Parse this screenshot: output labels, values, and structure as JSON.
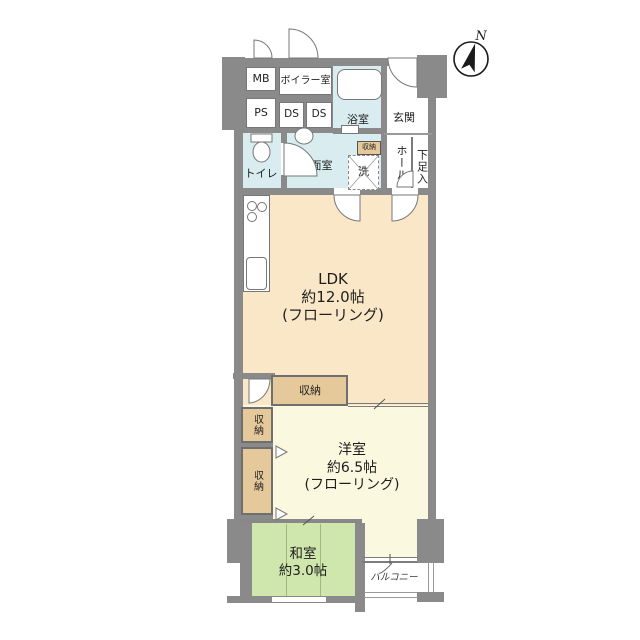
{
  "compass": {
    "north_label": "N"
  },
  "utility": {
    "mb": "MB",
    "boiler_room": "ボイラー室",
    "ps": "PS",
    "ds_left": "DS",
    "ds_right": "DS"
  },
  "wet_area": {
    "bath": "浴室",
    "toilet": "トイレ",
    "washroom": "洗面室",
    "washer": "洗",
    "storage_badge": "収納"
  },
  "entry": {
    "genkan": "玄関",
    "hall": "ホール",
    "shoe_closet": "下足入"
  },
  "ldk": {
    "name": "LDK",
    "size": "約12.0帖",
    "flooring": "(フローリング)"
  },
  "western_room": {
    "name": "洋室",
    "size": "約6.5帖",
    "flooring": "(フローリング)"
  },
  "japanese_room": {
    "name": "和室",
    "size": "約3.0帖"
  },
  "storage": {
    "top": "収納",
    "left_upper": "収納",
    "left_lower": "収納"
  },
  "balcony": {
    "label": "バルコニー"
  },
  "colors": {
    "wall": "#8a8a8a",
    "water_rooms": "#d9edf0",
    "ldk_fill": "#fae7c7",
    "western_fill": "#fbf8e0",
    "japanese_fill": "#cfe6ad",
    "storage_fill": "#e5c99a"
  }
}
